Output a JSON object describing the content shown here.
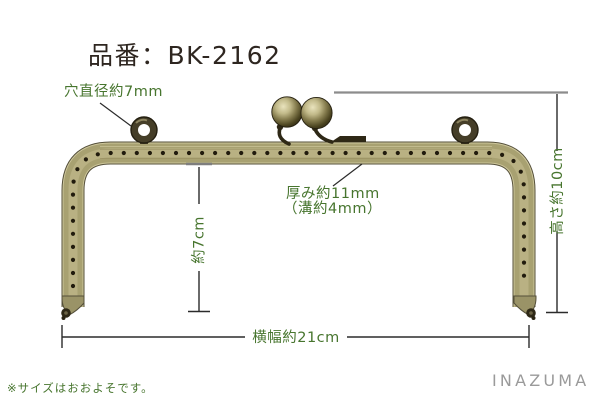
{
  "header": {
    "product_code": "品番：BK-2162"
  },
  "labels": {
    "hole_diameter": "穴直径約7mm",
    "thickness": "厚み約11mm",
    "groove": "（溝約4mm）",
    "inner_height": "約7cm",
    "frame_height": "高さ約10cm",
    "frame_width": "横幅約21cm"
  },
  "values": {
    "hole_diameter_mm": 7,
    "thickness_mm": 11,
    "groove_mm": 4,
    "inner_height_cm": 7,
    "frame_height_cm": 10,
    "frame_width_cm": 21
  },
  "footnote": "※サイズはおおよそです。",
  "brand": "INAZUMA",
  "colors": {
    "annotation_green": "#47752e",
    "title_black": "#2e2620",
    "brass_main": "#a8a171",
    "hole_dark": "#211b0d",
    "hardware_dark": "#2e2816",
    "line_black": "#2b2b2b",
    "ext_gray": "#8c8c8c",
    "logo_gray": "#9a9a9a"
  }
}
